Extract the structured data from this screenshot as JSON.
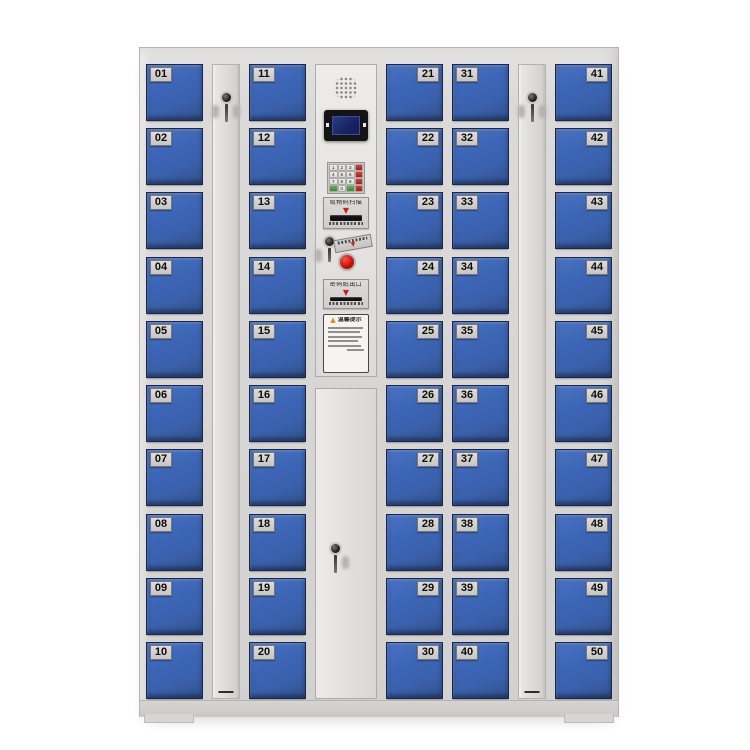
{
  "colors": {
    "door_blue": "#3c65b6",
    "door_border": "#1b2746",
    "cabinet_gray": "#d6d5d3",
    "panel_gray": "#e4e3e1",
    "number_plate_bg": "#d0cfcd",
    "number_text": "#0c0c0c",
    "screen_navy": "#1e2a66",
    "accent_red": "#ce1f14",
    "button_red": "#cc1105",
    "keypad_red_key": "#b02317",
    "keypad_green_key": "#4f9e4a"
  },
  "door_columns": [
    {
      "numbers": [
        "01",
        "02",
        "03",
        "04",
        "05",
        "06",
        "07",
        "08",
        "09",
        "10"
      ],
      "number_side": "left"
    },
    {
      "numbers": [
        "11",
        "12",
        "13",
        "14",
        "15",
        "16",
        "17",
        "18",
        "19",
        "20"
      ],
      "number_side": "left"
    },
    {
      "numbers": [
        "21",
        "22",
        "23",
        "24",
        "25",
        "26",
        "27",
        "28",
        "29",
        "30"
      ],
      "number_side": "right"
    },
    {
      "numbers": [
        "31",
        "32",
        "33",
        "34",
        "35",
        "36",
        "37",
        "38",
        "39",
        "40"
      ],
      "number_side": "left"
    },
    {
      "numbers": [
        "41",
        "42",
        "43",
        "44",
        "45",
        "46",
        "47",
        "48",
        "49",
        "50"
      ],
      "number_side": "right"
    }
  ],
  "control_panel": {
    "keypad_rows": [
      [
        "1",
        "2",
        "3",
        "fn"
      ],
      [
        "4",
        "5",
        "6",
        "fn"
      ],
      [
        "7",
        "8",
        "9",
        "fn"
      ],
      [
        "ok",
        "0",
        "ok",
        "fn"
      ]
    ],
    "scanner_label": "取物码扫描",
    "scanner_arrow": "▼",
    "receipt_label": "密码纸出口",
    "receipt_arrow": "▼",
    "button_arrow": "▼",
    "warning_triangle": "▲",
    "warning_title": "温馨提示"
  }
}
